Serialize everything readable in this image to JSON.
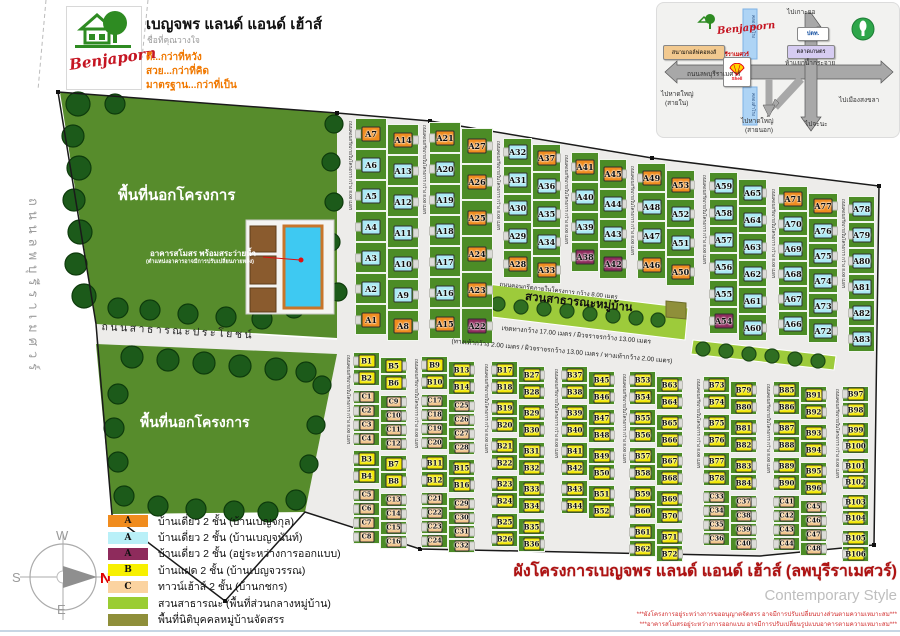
{
  "header": {
    "logo_script": "Benjaporn",
    "title": "เบญจพร แลนด์ แอนด์ เฮ้าส์",
    "subtitle": "ชื่อที่คุณวางใจ",
    "slogans": [
      "ดี...กว่าที่หวัง",
      "สวย...กว่าที่คิด",
      "มาตรฐาน...กว่าที่เป็น"
    ]
  },
  "inset": {
    "labels": [
      {
        "text": "ไปเกาะยอ",
        "x": 130,
        "y": 4
      },
      {
        "text": "ไปเมืองสงขลา",
        "x": 182,
        "y": 92
      },
      {
        "text": "ห้าแยกน้ำกระจาย",
        "x": 128,
        "y": 55
      },
      {
        "text": "ถนนลพบุรีราเมศวร์",
        "x": 30,
        "y": 66
      },
      {
        "text": "ไปหาดใหญ่",
        "x": 4,
        "y": 86
      },
      {
        "text": "(สายใน)",
        "x": 8,
        "y": 95
      },
      {
        "text": "ไปหาดใหญ่",
        "x": 84,
        "y": 113
      },
      {
        "text": "(สายนอก)",
        "x": 88,
        "y": 122
      },
      {
        "text": "ไปจะนะ",
        "x": 148,
        "y": 116
      }
    ],
    "brand_line": "เบญจพร ลพบุรีราเมศวร์",
    "logo_script": "Benjaporn",
    "canal_label": "คลองสำโรง",
    "landmarks": {
      "golf": "สนามกอล์ฟคอหงส์",
      "market": "ตลาดเกษตร",
      "ptt": "ปตท.",
      "shell": "Shell"
    }
  },
  "map": {
    "texts": {
      "outside_label": "พื้นที่นอกโครงการ",
      "left_road": "ถนนลพบุรีราเมศวร์",
      "public_road": "ถนนสาธารณะประโยชน์",
      "club_label": "อาคารสโมสร พร้อมสระว่ายน้ำ",
      "club_note": "(ตำแหน่งอาคารอาจมีการปรับเปลี่ยนภายหลัง)",
      "park_label": "สวนสาธารณะหมู่บ้าน",
      "road_spec_1": "เขตทางกว้าง 17.00 เมตร / ผิวจราจรกว้าง 13.00 เมตร",
      "road_spec_2": "(ทางเท้ากว้าง 2.00 เมตร / ผิวจราจรกว้าง 13.00 เมตร / ทางเท้ากว้าง 2.00 เมตร)"
    },
    "internal_road_label": "ถนนคอนกรีตภายในโครงการ กว้าง 8.00 เมตร",
    "cell_heights": {
      "b": 17,
      "t": 14
    },
    "groups": [
      {
        "id": "A-g1",
        "x": 346,
        "y": 118,
        "h": 31,
        "w": 32,
        "cols": [
          {
            "cells": [
              "A7:o",
              "A6:c",
              "A5:c",
              "A4:c",
              "A3:c",
              "A2:c",
              "A1:o"
            ]
          },
          {
            "dy": 6,
            "cells": [
              "A14:o",
              "A13:c",
              "A12:c",
              "A11:c",
              "A10:c",
              "A9:c",
              "A8:o"
            ]
          }
        ]
      },
      {
        "id": "A-g2",
        "x": 420,
        "y": 122,
        "h": 31,
        "w": 32,
        "cols": [
          {
            "cells": [
              "A21:o",
              "A20:c",
              "A19:c",
              "A18:c",
              "A17:c",
              "A16:c",
              "A15:o"
            ]
          },
          {
            "dy": 6,
            "h": 36,
            "cells": [
              "A27:o",
              "A26:o",
              "A25:o",
              "A24:o",
              "A23:o",
              "A22:m"
            ]
          }
        ]
      },
      {
        "id": "A-g3",
        "x": 494,
        "y": 138,
        "h": 28,
        "w": 29,
        "cols": [
          {
            "cells": [
              "A32:c",
              "A31:c",
              "A30:c",
              "A29:c",
              "A28:o"
            ]
          },
          {
            "dy": 6,
            "cells": [
              "A37:o",
              "A36:c",
              "A35:c",
              "A34:c",
              "A33:o"
            ]
          }
        ]
      },
      {
        "id": "A-g4",
        "x": 562,
        "y": 152,
        "h": 30,
        "w": 28,
        "cols": [
          {
            "cells": [
              "A41:o",
              "A40:c",
              "A39:c",
              "A38:m"
            ]
          },
          {
            "dy": 7,
            "cells": [
              "A45:o",
              "A44:c",
              "A43:c",
              "A42:m"
            ]
          }
        ]
      },
      {
        "id": "A-g5",
        "x": 628,
        "y": 163,
        "h": 29,
        "w": 29,
        "cols": [
          {
            "cells": [
              "A49:o",
              "A48:c",
              "A47:c",
              "A46:o"
            ]
          },
          {
            "dy": 7,
            "cells": [
              "A53:o",
              "A52:c",
              "A51:c",
              "A50:o"
            ]
          }
        ]
      },
      {
        "id": "A-g6",
        "x": 700,
        "y": 172,
        "h": 27,
        "w": 29,
        "cols": [
          {
            "cells": [
              "A59:c",
              "A58:c",
              "A57:c",
              "A56:c",
              "A55:c",
              "A54:m"
            ]
          },
          {
            "dy": 7,
            "cells": [
              "A65:c",
              "A64:c",
              "A63:c",
              "A62:c",
              "A61:c",
              "A60:c"
            ]
          }
        ]
      },
      {
        "id": "A-g7",
        "x": 769,
        "y": 186,
        "h": 25,
        "w": 30,
        "cols": [
          {
            "cells": [
              "A71:o",
              "A70:c",
              "A69:c",
              "A68:c",
              "A67:c",
              "A66:c"
            ]
          },
          {
            "dy": 7,
            "cells": [
              "A77:o",
              "A76:c",
              "A75:c",
              "A74:c",
              "A73:c",
              "A72:c"
            ]
          }
        ]
      },
      {
        "id": "A-g8",
        "x": 839,
        "y": 196,
        "h": 26,
        "w": 27,
        "cols": [
          {
            "cells": [
              "A78:c",
              "A79:c",
              "A80:c",
              "A81:c",
              "A82:c",
              "A83:c"
            ]
          }
        ]
      },
      {
        "id": "B-g1",
        "x": 344,
        "y": 352,
        "w": 27,
        "cols": [
          {
            "cells": [
              "B1:b",
              "B2:b",
              "|",
              "C1:t",
              "C2:t",
              "C3:t",
              "C4:t",
              "|",
              "B3:b",
              "B4:b",
              "|",
              "C5:t",
              "C6:t",
              "C7:t",
              "C8:t"
            ]
          },
          {
            "dy": 5,
            "cells": [
              "B5:b",
              "B6:b",
              "|",
              "C9:t",
              "C10:t",
              "C11:t",
              "C12:t",
              "|",
              "B7:b",
              "B8:b",
              "|",
              "C13:t",
              "C14:t",
              "C15:t",
              "C16:t"
            ]
          }
        ]
      },
      {
        "id": "B-g2",
        "x": 412,
        "y": 356,
        "w": 27,
        "cols": [
          {
            "cells": [
              "B9:b",
              "B10:b",
              "|",
              "C17:t",
              "C18:t",
              "C19:t",
              "C20:t",
              "|",
              "B11:b",
              "B12:b",
              "|",
              "C21:t",
              "C22:t",
              "C23:t",
              "C24:t"
            ]
          },
          {
            "dy": 5,
            "cells": [
              "B13:b",
              "B14:b",
              "|",
              "C25:t",
              "C26:t",
              "C27:t",
              "C28:t",
              "|",
              "B15:b",
              "B16:b",
              "|",
              "C29:t",
              "C30:t",
              "C31:t",
              "C32:t"
            ]
          }
        ]
      },
      {
        "id": "B-g3",
        "x": 482,
        "y": 361,
        "w": 27,
        "cols": [
          {
            "cells": [
              "B17:b",
              "B18:b",
              "|",
              "B19:b",
              "B20:b",
              "|",
              "B21:b",
              "B22:b",
              "|",
              "B23:b",
              "B24:b",
              "|",
              "B25:b",
              "B26:b"
            ]
          },
          {
            "dy": 5,
            "cells": [
              "B27:b",
              "B28:b",
              "|",
              "B29:b",
              "B30:b",
              "|",
              "B31:b",
              "B32:b",
              "|",
              "B33:b",
              "B34:b",
              "|",
              "B35:b",
              "B36:b"
            ]
          }
        ]
      },
      {
        "id": "B-g4",
        "x": 552,
        "y": 366,
        "w": 27,
        "cols": [
          {
            "cells": [
              "B37:b",
              "B38:b",
              "|",
              "B39:b",
              "B40:b",
              "|",
              "B41:b",
              "B42:b",
              "|",
              "B43:b",
              "B44:b"
            ]
          },
          {
            "dy": 5,
            "cells": [
              "B45:b",
              "B46:b",
              "|",
              "B47:b",
              "B48:b",
              "|",
              "B49:b",
              "B50:b",
              "|",
              "B51:b",
              "B52:b"
            ]
          }
        ]
      },
      {
        "id": "B-g5",
        "x": 620,
        "y": 371,
        "w": 27,
        "cols": [
          {
            "cells": [
              "B53:b",
              "B54:b",
              "|",
              "B55:b",
              "B56:b",
              "|",
              "B57:b",
              "B58:b",
              "|",
              "B59:b",
              "B60:b",
              "|",
              "B61:b",
              "B62:b"
            ]
          },
          {
            "dy": 5,
            "cells": [
              "B63:b",
              "B64:b",
              "|",
              "B65:b",
              "B66:b",
              "|",
              "B67:b",
              "B68:b",
              "|",
              "B69:b",
              "B70:b",
              "|",
              "B71:b",
              "B72:b"
            ]
          }
        ]
      },
      {
        "id": "B-g6",
        "x": 694,
        "y": 376,
        "w": 27,
        "cols": [
          {
            "cells": [
              "B73:b",
              "B74:b",
              "|",
              "B75:b",
              "B76:b",
              "|",
              "B77:b",
              "B78:b",
              "|",
              "C33:t",
              "C34:t",
              "C35:t",
              "C36:t"
            ]
          },
          {
            "dy": 5,
            "cells": [
              "B79:b",
              "B80:b",
              "|",
              "B81:b",
              "B82:b",
              "|",
              "B83:b",
              "B84:b",
              "|",
              "C37:t",
              "C38:t",
              "C39:t",
              "C40:t"
            ]
          }
        ]
      },
      {
        "id": "B-g7",
        "x": 764,
        "y": 381,
        "w": 27,
        "cols": [
          {
            "cells": [
              "B85:b",
              "B86:b",
              "|",
              "B87:b",
              "B88:b",
              "|",
              "B89:b",
              "B90:b",
              "|",
              "C41:t",
              "C42:t",
              "C43:t",
              "C44:t"
            ]
          },
          {
            "dy": 5,
            "cells": [
              "B91:b",
              "B92:b",
              "|",
              "B93:b",
              "B94:b",
              "|",
              "B95:b",
              "B96:b",
              "|",
              "C45:t",
              "C46:t",
              "C47:t",
              "C48:t"
            ]
          }
        ]
      },
      {
        "id": "B-g8",
        "x": 833,
        "y": 386,
        "w": 27,
        "cols": [
          {
            "h": 16,
            "cells": [
              "B97:b",
              "B98:b",
              "|",
              "B99:b",
              "B100:b",
              "|",
              "B101:b",
              "B102:b",
              "|",
              "B103:b",
              "B104:b",
              "|",
              "B105:b",
              "B106:b"
            ]
          }
        ]
      }
    ],
    "trees": {
      "outer": [
        [
          78,
          104,
          12
        ],
        [
          73,
          136,
          11
        ],
        [
          79,
          168,
          12
        ],
        [
          74,
          200,
          11
        ],
        [
          80,
          232,
          12
        ],
        [
          76,
          264,
          11
        ],
        [
          84,
          296,
          12
        ],
        [
          115,
          104,
          10
        ],
        [
          334,
          124,
          9
        ],
        [
          331,
          162,
          9
        ],
        [
          334,
          202,
          9
        ],
        [
          331,
          242,
          9
        ],
        [
          338,
          292,
          9
        ],
        [
          118,
          308,
          10
        ],
        [
          150,
          310,
          10
        ],
        [
          188,
          314,
          10
        ],
        [
          226,
          317,
          10
        ],
        [
          262,
          319,
          10
        ],
        [
          294,
          308,
          10
        ],
        [
          132,
          357,
          11
        ],
        [
          168,
          360,
          11
        ],
        [
          204,
          363,
          11
        ],
        [
          240,
          366,
          11
        ],
        [
          276,
          369,
          11
        ],
        [
          306,
          372,
          10
        ],
        [
          118,
          394,
          10
        ],
        [
          114,
          428,
          10
        ],
        [
          118,
          462,
          10
        ],
        [
          124,
          496,
          10
        ],
        [
          158,
          506,
          10
        ],
        [
          196,
          509,
          10
        ],
        [
          234,
          511,
          10
        ],
        [
          268,
          512,
          10
        ],
        [
          296,
          500,
          10
        ],
        [
          322,
          385,
          9
        ],
        [
          316,
          425,
          9
        ],
        [
          309,
          464,
          9
        ]
      ],
      "park": [
        [
          498,
          304,
          7
        ],
        [
          521,
          307,
          7
        ],
        [
          544,
          309,
          7
        ],
        [
          567,
          311,
          7
        ],
        [
          590,
          314,
          7
        ],
        [
          613,
          316,
          7
        ],
        [
          636,
          318,
          7
        ],
        [
          658,
          320,
          7
        ],
        [
          703,
          349,
          7
        ],
        [
          726,
          351,
          7
        ],
        [
          749,
          354,
          7
        ],
        [
          772,
          356,
          7
        ],
        [
          795,
          359,
          7
        ],
        [
          818,
          361,
          7
        ]
      ]
    }
  },
  "legend": {
    "items": [
      {
        "letter": "A",
        "color": "#F08C1E",
        "text": "บ้านเดี่ยว  2 ชั้น (บ้านเบญจกุล)"
      },
      {
        "letter": "A",
        "color": "#B9F0F8",
        "text": "บ้านเดี่ยว  2 ชั้น (บ้านเบญจนันท์)"
      },
      {
        "letter": "A",
        "color": "#8E2B5C",
        "text": "บ้านเดี่ยว  2 ชั้น (อยู่ระหว่างการออกแบบ)"
      },
      {
        "letter": "B",
        "color": "#F7F000",
        "text": "บ้านแฝด   2 ชั้น (บ้านเบญจวรรณ)"
      },
      {
        "letter": "C",
        "color": "#FBD3A0",
        "text": "ทาวน์เฮ้าส์ 2 ชั้น (บ้านกชกร)"
      },
      {
        "letter": "",
        "color": "#9ACD32",
        "text": "สวนสาธารณะ   (พื้นที่ส่วนกลางหมู่บ้าน)"
      },
      {
        "letter": "",
        "color": "#8F8F3A",
        "text": "พื้นที่นิติบุคคลหมู่บ้านจัดสรร"
      }
    ]
  },
  "compass": {
    "n": "N",
    "s": "S",
    "e": "E",
    "w": "W"
  },
  "footer": {
    "title": "ผังโครงการเบญจพร แลนด์ แอนด์ เฮ้าส์ (ลพบุรีราเมศวร์)",
    "style_name": "Contemporary Style",
    "notes": [
      "***ผังโครงการอยู่ระหว่างการขออนุญาตจัดสรร อาจมีการปรับเปลี่ยนบางส่วนตามความเหมาะสม***",
      "***อาคารสโมสรอยู่ระหว่างการออกแบบ อาจมีการปรับเปลี่ยนรูปแบบอาคารตามความเหมาะสม***"
    ]
  },
  "colors": {
    "plot_green": "#4C8C26",
    "outside_green": "#578C2C",
    "park_green": "#9DCB3B",
    "road_gray": "#EDECEA",
    "orange": "#F08C1E",
    "cyan": "#A9E9F4",
    "maroon": "#8E2B5C",
    "yellow": "#F2E800",
    "peach": "#F2C489",
    "olive": "#8F8F3A",
    "pool": "#3EC9F2",
    "title_red": "#AE1212",
    "accent_orange": "#F07800"
  }
}
